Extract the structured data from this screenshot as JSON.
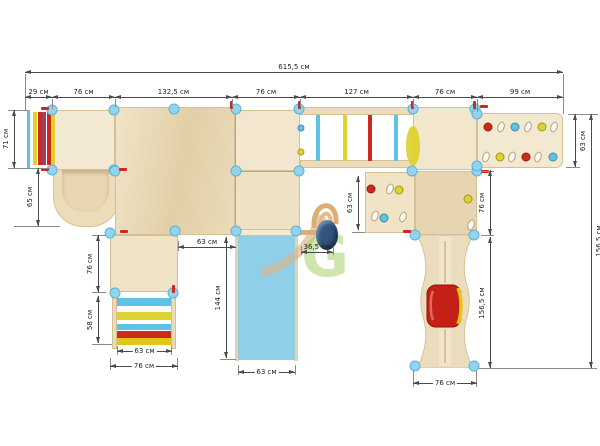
{
  "watermark": {
    "letter": "G"
  },
  "unit": "см",
  "colors": {
    "wood_light": "#f4e9d2",
    "wood_mid": "#ecdcba",
    "wood_dark": "#e9d6b2",
    "wood_edge": "#d6bf96",
    "slide_blue": "#8fd0e8",
    "post_blue": "#92d4ee",
    "post_edge": "#5ab4d8",
    "rung_blue": "#5ec2e6",
    "yellow": "#ddd22e",
    "gold": "#e4c51a",
    "red": "#cc2a1d",
    "maroon": "#a04059",
    "tube_red": "#c42015",
    "dim": "#4a4a4a",
    "text": "#222222",
    "wm_green": "#8dc63f",
    "wm_tan": "#d9ad78",
    "egg_blue": "#34547e"
  },
  "dims": [
    {
      "label": "615,5 см",
      "dir": "h",
      "x": 25,
      "y": 72,
      "len": 538,
      "lab": "above"
    },
    {
      "label": "29 см",
      "dir": "h",
      "x": 25,
      "y": 97,
      "len": 27,
      "lab": "above"
    },
    {
      "label": "76 см",
      "dir": "h",
      "x": 52,
      "y": 97,
      "len": 63,
      "lab": "above"
    },
    {
      "label": "132,5 см",
      "dir": "h",
      "x": 115,
      "y": 97,
      "len": 117,
      "lab": "above"
    },
    {
      "label": "76 см",
      "dir": "h",
      "x": 232,
      "y": 97,
      "len": 68,
      "lab": "above"
    },
    {
      "label": "127 см",
      "dir": "h",
      "x": 300,
      "y": 97,
      "len": 113,
      "lab": "above"
    },
    {
      "label": "76 см",
      "dir": "h",
      "x": 413,
      "y": 97,
      "len": 64,
      "lab": "above"
    },
    {
      "label": "99 см",
      "dir": "h",
      "x": 477,
      "y": 97,
      "len": 86,
      "lab": "above"
    },
    {
      "label": "71 см",
      "dir": "v",
      "x": 14,
      "y": 110,
      "len": 58,
      "side": "left"
    },
    {
      "label": "65 см",
      "dir": "v",
      "x": 38,
      "y": 168,
      "len": 58,
      "side": "left"
    },
    {
      "label": "63 см",
      "dir": "v",
      "x": 575,
      "y": 114,
      "len": 53,
      "side": "right"
    },
    {
      "label": "156,5 см",
      "dir": "v",
      "x": 591,
      "y": 114,
      "len": 254,
      "side": "right"
    },
    {
      "label": "76 см",
      "dir": "v",
      "x": 490,
      "y": 170,
      "len": 65,
      "side": "left"
    },
    {
      "label": "156,5 см",
      "dir": "v",
      "x": 490,
      "y": 237,
      "len": 131,
      "side": "left"
    },
    {
      "label": "63 см",
      "dir": "v",
      "x": 358,
      "y": 176,
      "len": 54,
      "side": "left"
    },
    {
      "label": "36,5 см",
      "dir": "h",
      "x": 301,
      "y": 252,
      "len": 32,
      "lab": "above"
    },
    {
      "label": "63 см",
      "dir": "h",
      "x": 178,
      "y": 247,
      "len": 58,
      "lab": "above"
    },
    {
      "label": "144 см",
      "dir": "v",
      "x": 226,
      "y": 237,
      "len": 121,
      "side": "left"
    },
    {
      "label": "63 см",
      "dir": "h",
      "x": 238,
      "y": 372,
      "len": 57,
      "lab": "on"
    },
    {
      "label": "76 см",
      "dir": "v",
      "x": 98,
      "y": 235,
      "len": 57,
      "side": "left"
    },
    {
      "label": "58 см",
      "dir": "v",
      "x": 98,
      "y": 296,
      "len": 47,
      "side": "left"
    },
    {
      "label": "63 см",
      "dir": "h",
      "x": 117,
      "y": 351,
      "len": 55,
      "lab": "on"
    },
    {
      "label": "76 см",
      "dir": "h",
      "x": 110,
      "y": 366,
      "len": 68,
      "lab": "on"
    },
    {
      "label": "76 см",
      "dir": "h",
      "x": 413,
      "y": 383,
      "len": 64,
      "lab": "on"
    }
  ],
  "ext_lines": [
    [
      25,
      74,
      1,
      36
    ],
    [
      563,
      74,
      1,
      40
    ],
    [
      52,
      99,
      1,
      10
    ],
    [
      115,
      99,
      1,
      8
    ],
    [
      232,
      99,
      1,
      8
    ],
    [
      300,
      99,
      1,
      8
    ],
    [
      413,
      99,
      1,
      8
    ],
    [
      477,
      99,
      1,
      13
    ],
    [
      8,
      110,
      20,
      1
    ],
    [
      8,
      168,
      42,
      1
    ],
    [
      14,
      226,
      46,
      1
    ],
    [
      568,
      114,
      30,
      1
    ],
    [
      566,
      167,
      14,
      1
    ],
    [
      481,
      171,
      13,
      1
    ],
    [
      481,
      235,
      13,
      1
    ],
    [
      479,
      368,
      118,
      1
    ],
    [
      352,
      232,
      13,
      1
    ],
    [
      178,
      241,
      1,
      10
    ],
    [
      220,
      359,
      16,
      1
    ],
    [
      92,
      235,
      14,
      1
    ],
    [
      92,
      292,
      14,
      1
    ],
    [
      92,
      344,
      20,
      1
    ],
    [
      117,
      346,
      1,
      9
    ],
    [
      171,
      346,
      1,
      9
    ],
    [
      110,
      358,
      1,
      12
    ],
    [
      177,
      358,
      1,
      12
    ],
    [
      413,
      371,
      1,
      16
    ],
    [
      476,
      371,
      1,
      16
    ],
    [
      295,
      365,
      1,
      10
    ],
    [
      238,
      365,
      1,
      10
    ],
    [
      301,
      246,
      1,
      9
    ],
    [
      333,
      246,
      1,
      9
    ]
  ],
  "posts": [
    [
      52,
      110
    ],
    [
      114,
      110
    ],
    [
      52,
      170
    ],
    [
      114,
      170
    ],
    [
      174,
      109
    ],
    [
      236,
      109
    ],
    [
      299,
      109
    ],
    [
      413,
      109
    ],
    [
      475,
      109
    ],
    [
      115,
      171
    ],
    [
      236,
      171
    ],
    [
      299,
      171
    ],
    [
      412,
      171
    ],
    [
      477,
      171
    ],
    [
      110,
      233
    ],
    [
      175,
      231
    ],
    [
      236,
      231
    ],
    [
      296,
      231
    ],
    [
      415,
      235
    ],
    [
      474,
      235
    ],
    [
      415,
      366
    ],
    [
      474,
      366
    ],
    [
      115,
      293
    ],
    [
      173,
      293
    ],
    [
      477,
      114
    ],
    [
      477,
      166
    ]
  ],
  "red_markers": [
    {
      "x": 230,
      "y": 101,
      "o": "v"
    },
    {
      "x": 298,
      "y": 101,
      "o": "v"
    },
    {
      "x": 411,
      "y": 101,
      "o": "v"
    },
    {
      "x": 473,
      "y": 101,
      "o": "v"
    },
    {
      "x": 172,
      "y": 285,
      "o": "v"
    },
    {
      "x": 41,
      "y": 107,
      "o": "h"
    },
    {
      "x": 41,
      "y": 168,
      "o": "h"
    },
    {
      "x": 119,
      "y": 168,
      "o": "h"
    },
    {
      "x": 480,
      "y": 105,
      "o": "h"
    },
    {
      "x": 481,
      "y": 170,
      "o": "h"
    },
    {
      "x": 403,
      "y": 230,
      "o": "h"
    },
    {
      "x": 120,
      "y": 230,
      "o": "h"
    }
  ],
  "holds": [
    {
      "x": 488,
      "y": 127,
      "t": "dot",
      "c": "red"
    },
    {
      "x": 501,
      "y": 127,
      "t": "oval"
    },
    {
      "x": 515,
      "y": 127,
      "t": "dot",
      "c": "rung_blue"
    },
    {
      "x": 528,
      "y": 127,
      "t": "oval"
    },
    {
      "x": 542,
      "y": 127,
      "t": "dot",
      "c": "yellow"
    },
    {
      "x": 554,
      "y": 127,
      "t": "oval"
    },
    {
      "x": 486,
      "y": 157,
      "t": "oval"
    },
    {
      "x": 500,
      "y": 157,
      "t": "dot",
      "c": "yellow"
    },
    {
      "x": 512,
      "y": 157,
      "t": "oval"
    },
    {
      "x": 526,
      "y": 157,
      "t": "dot",
      "c": "red"
    },
    {
      "x": 538,
      "y": 157,
      "t": "oval"
    },
    {
      "x": 553,
      "y": 157,
      "t": "dot",
      "c": "rung_blue"
    },
    {
      "x": 371,
      "y": 189,
      "t": "dot",
      "c": "red"
    },
    {
      "x": 390,
      "y": 189,
      "t": "oval"
    },
    {
      "x": 399,
      "y": 190,
      "t": "dot",
      "c": "yellow"
    },
    {
      "x": 375,
      "y": 216,
      "t": "oval"
    },
    {
      "x": 384,
      "y": 218,
      "t": "dot",
      "c": "rung_blue"
    },
    {
      "x": 403,
      "y": 217,
      "t": "oval"
    },
    {
      "x": 468,
      "y": 199,
      "t": "dot",
      "c": "yellow"
    },
    {
      "x": 471,
      "y": 225,
      "t": "oval"
    }
  ],
  "pegs": [
    {
      "x": 301,
      "y": 128,
      "c": "rung_blue"
    },
    {
      "x": 301,
      "y": 152,
      "c": "yellow"
    }
  ],
  "bridge_rungs": {
    "y": 115,
    "h": 46,
    "w": 4,
    "items": [
      {
        "x": 316,
        "c": "rung_blue"
      },
      {
        "x": 343,
        "c": "yellow"
      },
      {
        "x": 368,
        "c": "red"
      },
      {
        "x": 394,
        "c": "rung_blue"
      }
    ]
  },
  "left_ladder": {
    "rail": [
      27,
      110,
      3,
      58
    ],
    "y": 112,
    "h": 53,
    "w": 4,
    "stripes": [
      {
        "x": 33,
        "c": "yellow"
      },
      {
        "x": 37.5,
        "c": "red"
      },
      {
        "x": 42,
        "c": "maroon"
      },
      {
        "x": 46.5,
        "c": "red"
      },
      {
        "x": 51,
        "c": "yellow"
      }
    ]
  },
  "bottom_ladder": {
    "x": 117,
    "w": 54,
    "stripes": [
      {
        "y": 298,
        "h": 8,
        "c": "rung_blue"
      },
      {
        "y": 312,
        "h": 8,
        "c": "yellow"
      },
      {
        "y": 324,
        "h": 6,
        "c": "rung_blue"
      },
      {
        "y": 331,
        "h": 7,
        "c": "red"
      },
      {
        "y": 338,
        "h": 7,
        "c": "gold"
      }
    ]
  }
}
